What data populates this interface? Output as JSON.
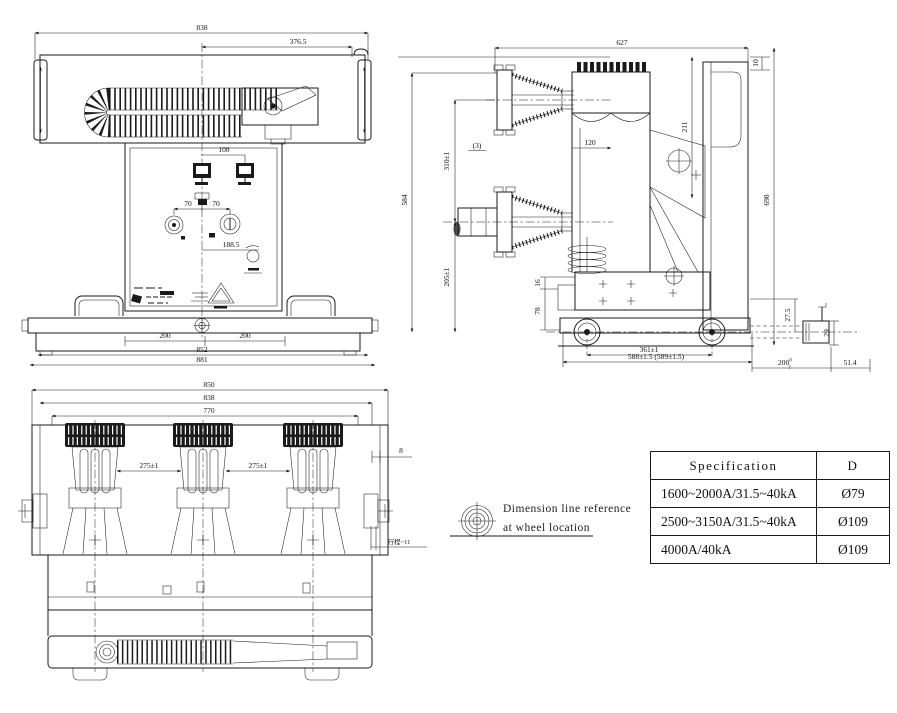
{
  "colors": {
    "line": "#1a1a1a",
    "background": "#ffffff"
  },
  "front_view": {
    "dims": {
      "d838": "838",
      "d376": "376.5",
      "d108": "108",
      "d70a": "70",
      "d70b": "70",
      "d188": "188.5",
      "d200a": "200",
      "d200b": "200",
      "d852": "852",
      "d881": "881"
    }
  },
  "side_view": {
    "dims": {
      "d627": "627",
      "d10": "10",
      "d698": "698",
      "d211": "211",
      "d584": "584",
      "d310": "310±1",
      "d3": "(3)",
      "d120": "120",
      "d205": "205±1",
      "d16": "16",
      "d78": "78",
      "d361": "361±1",
      "d588": "588±1.5 (589±1.5)",
      "d27": "27.5",
      "d29": "29",
      "d200": "200",
      "d200sup": "0",
      "d200sub": "2",
      "d514": "51.4"
    }
  },
  "bottom_view": {
    "dims": {
      "d850": "850",
      "d838": "838",
      "d770": "770",
      "d275a": "275±1",
      "d275b": "275±1",
      "d8": "8",
      "dstroke": "行程~11"
    }
  },
  "note": {
    "line1": "Dimension line reference",
    "line2": "at wheel location"
  },
  "spec_table": {
    "headers": [
      "Specification",
      "D"
    ],
    "rows": [
      [
        "1600~2000A/31.5~40kA",
        "Ø79"
      ],
      [
        "2500~3150A/31.5~40kA",
        "Ø109"
      ],
      [
        "4000A/40kA",
        "Ø109"
      ]
    ]
  }
}
